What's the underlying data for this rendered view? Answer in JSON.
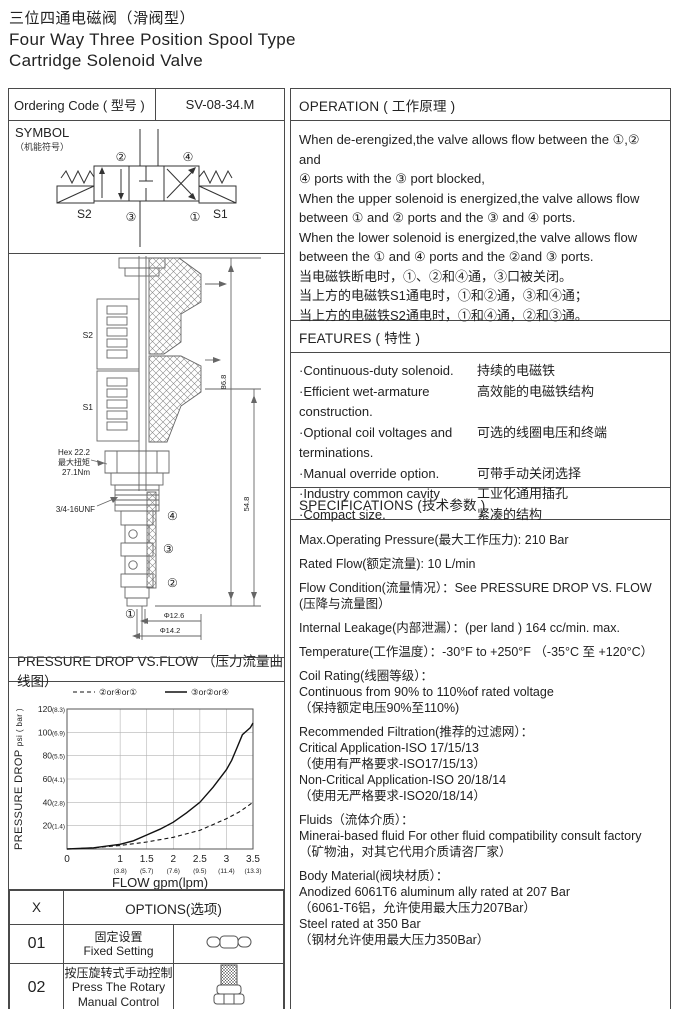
{
  "title": {
    "zh": "三位四通电磁阀（滑阀型）",
    "en_line1": "Four Way Three Position Spool Type",
    "en_line2": "Cartridge Solenoid Valve"
  },
  "ordering": {
    "label": "Ordering Code ( 型号 )",
    "code": "SV-08-34.M"
  },
  "operation": {
    "header": "OPERATION ( 工作原理 )",
    "body": "When de-erengized,the valve allows flow between the ①,② and\n④ ports with the ③ port blocked,\nWhen the upper solenoid is energized,the valve allows flow\nbetween ① and ② ports and the ③ and ④ ports.\nWhen the lower solenoid is energized,the valve allows flow\nbetween the ① and ④ ports and the ②and ③ ports.\n当电磁铁断电时，①、②和④通，③口被关闭。\n当上方的电磁铁S1通电时，①和②通，③和④通；\n当上方的电磁铁S2通电时，①和④通，②和③通。"
  },
  "symbol": {
    "title": "SYMBOL",
    "subtitle": "（机能符号）",
    "port1": "①",
    "port2": "②",
    "port3": "③",
    "port4": "④",
    "s1": "S1",
    "s2": "S2"
  },
  "drawing": {
    "coil_upper": "S2",
    "coil_lower": "S1",
    "hex_line1": "Hex 22.2",
    "hex_line2": "最大扭矩",
    "hex_line3": "27.1Nm",
    "thread": "3/4-16UNF",
    "dim_total": "86.8",
    "dim_lower": "54.8",
    "dim_dia1": "Φ12.6",
    "dim_dia2": "Φ14.2",
    "port1": "①",
    "port2": "②",
    "port3": "③",
    "port4": "④"
  },
  "features": {
    "header": "FEATURES ( 特性 )",
    "items": [
      {
        "en": "·Continuous-duty  solenoid.",
        "zh": "持续的电磁铁"
      },
      {
        "en": "·Efficient wet-armature construction.",
        "zh": "高效能的电磁铁结构"
      },
      {
        "en": "·Optional coil voltages and terminations.",
        "zh": "可选的线圈电压和终端"
      },
      {
        "en": "·Manual override option.",
        "zh": "可带手动关闭选择"
      },
      {
        "en": "·Industry common cavity",
        "zh": "工业化通用插孔"
      },
      {
        "en": "·Compact size.",
        "zh": "紧凑的结构"
      }
    ]
  },
  "specifications": {
    "header": "SPECIFICATIONS (技术参数 )",
    "paragraphs": [
      "Max.Operating Pressure(最大工作压力): 210 Bar",
      "Rated Flow(额定流量): 10 L/min",
      "Flow Condition(流量情况）：See PRESSURE DROP VS. FLOW\n(压降与流量图）",
      "Internal Leakage(内部泄漏）：(per land ) 164 cc/min. max.",
      "Temperature(工作温度）：-30°F to +250°F  （-35°C 至 +120°C）",
      "Coil Rating(线圈等级）：\nContinuous from 90% to 110%of rated voltage\n（保持额定电压90%至110%)",
      "Recommended Filtration(推荐的过滤网）：\nCritical Application-ISO 17/15/13\n（使用有严格要求-ISO17/15/13）\nNon-Critical Application-ISO 20/18/14\n（使用无严格要求-ISO20/18/14）",
      "Fluids（流体介质）：\nMinerai-based fluid For other  fluid compatibility consult  factory\n（矿物油，对其它代用介质请咨厂家）",
      "Body Material(阀块材质）：\nAnodized 6061T6 aluminum ally rated at 207 Bar\n（6061-T6铝，允许使用最大压力207Bar）\nSteel rated at 350 Bar\n（钢材允许使用最大压力350Bar）"
    ]
  },
  "pressure_section": {
    "header": "PRESSURE DROP VS.FLOW （压力流量曲线图）"
  },
  "chart_data": {
    "type": "line",
    "title": "PRESSURE DROP VS.FLOW （压力流量曲线图）",
    "xlabel": "FLOW gpm(lpm)",
    "ylabel": "PRESSURE DROP psi ( bar )",
    "ylabel_main": "PRESSURE DROP",
    "ylabel_sub": "psi ( bar )",
    "xlim": [
      0,
      3.5
    ],
    "ylim": [
      0,
      120
    ],
    "grid": true,
    "legend_position": "top",
    "x_ticks": [
      {
        "v": 0,
        "label": "0",
        "lpm": ""
      },
      {
        "v": 1,
        "label": "1",
        "lpm": "(3.8)"
      },
      {
        "v": 1.5,
        "label": "1.5",
        "lpm": "(5.7)"
      },
      {
        "v": 2,
        "label": "2",
        "lpm": "(7.6)"
      },
      {
        "v": 2.5,
        "label": "2.5",
        "lpm": "(9.5)"
      },
      {
        "v": 3,
        "label": "3",
        "lpm": "(11.4)"
      },
      {
        "v": 3.5,
        "label": "3.5",
        "lpm": "(13.3)"
      }
    ],
    "y_ticks": [
      {
        "v": 20,
        "label": "20",
        "bar": "(1.4)"
      },
      {
        "v": 40,
        "label": "40",
        "bar": "(2.8)"
      },
      {
        "v": 60,
        "label": "60",
        "bar": "(4.1)"
      },
      {
        "v": 80,
        "label": "80",
        "bar": "(5.5)"
      },
      {
        "v": 100,
        "label": "100",
        "bar": "(6.9)"
      },
      {
        "v": 120,
        "label": "120",
        "bar": "(8.3)"
      }
    ],
    "series": [
      {
        "name": "②or④or①",
        "style": "dashed",
        "points": [
          [
            0,
            0
          ],
          [
            0.5,
            1
          ],
          [
            1,
            3
          ],
          [
            1.5,
            6
          ],
          [
            2,
            10
          ],
          [
            2.5,
            16
          ],
          [
            3,
            26
          ],
          [
            3.25,
            32
          ],
          [
            3.5,
            40
          ]
        ]
      },
      {
        "name": "③or②or④",
        "style": "solid",
        "points": [
          [
            0,
            0
          ],
          [
            0.5,
            1
          ],
          [
            1,
            4
          ],
          [
            1.25,
            7
          ],
          [
            1.5,
            12
          ],
          [
            1.75,
            17
          ],
          [
            2,
            23
          ],
          [
            2.25,
            31
          ],
          [
            2.5,
            40
          ],
          [
            2.75,
            53
          ],
          [
            3,
            68
          ],
          [
            3.1,
            76
          ],
          [
            3.2,
            87
          ],
          [
            3.3,
            98
          ],
          [
            3.4,
            102
          ],
          [
            3.45,
            104
          ],
          [
            3.5,
            108
          ]
        ]
      }
    ]
  },
  "options": {
    "col1_header": "X",
    "col2_header": "OPTIONS(选项)",
    "rows": [
      {
        "code": "01",
        "zh": "固定设置",
        "en": "Fixed Setting",
        "icon": "fixed-setting-icon"
      },
      {
        "code": "02",
        "zh": "按压旋转式手动控制",
        "en": "Press The Rotary\nManual Control",
        "icon": "rotary-knob-icon"
      }
    ]
  }
}
